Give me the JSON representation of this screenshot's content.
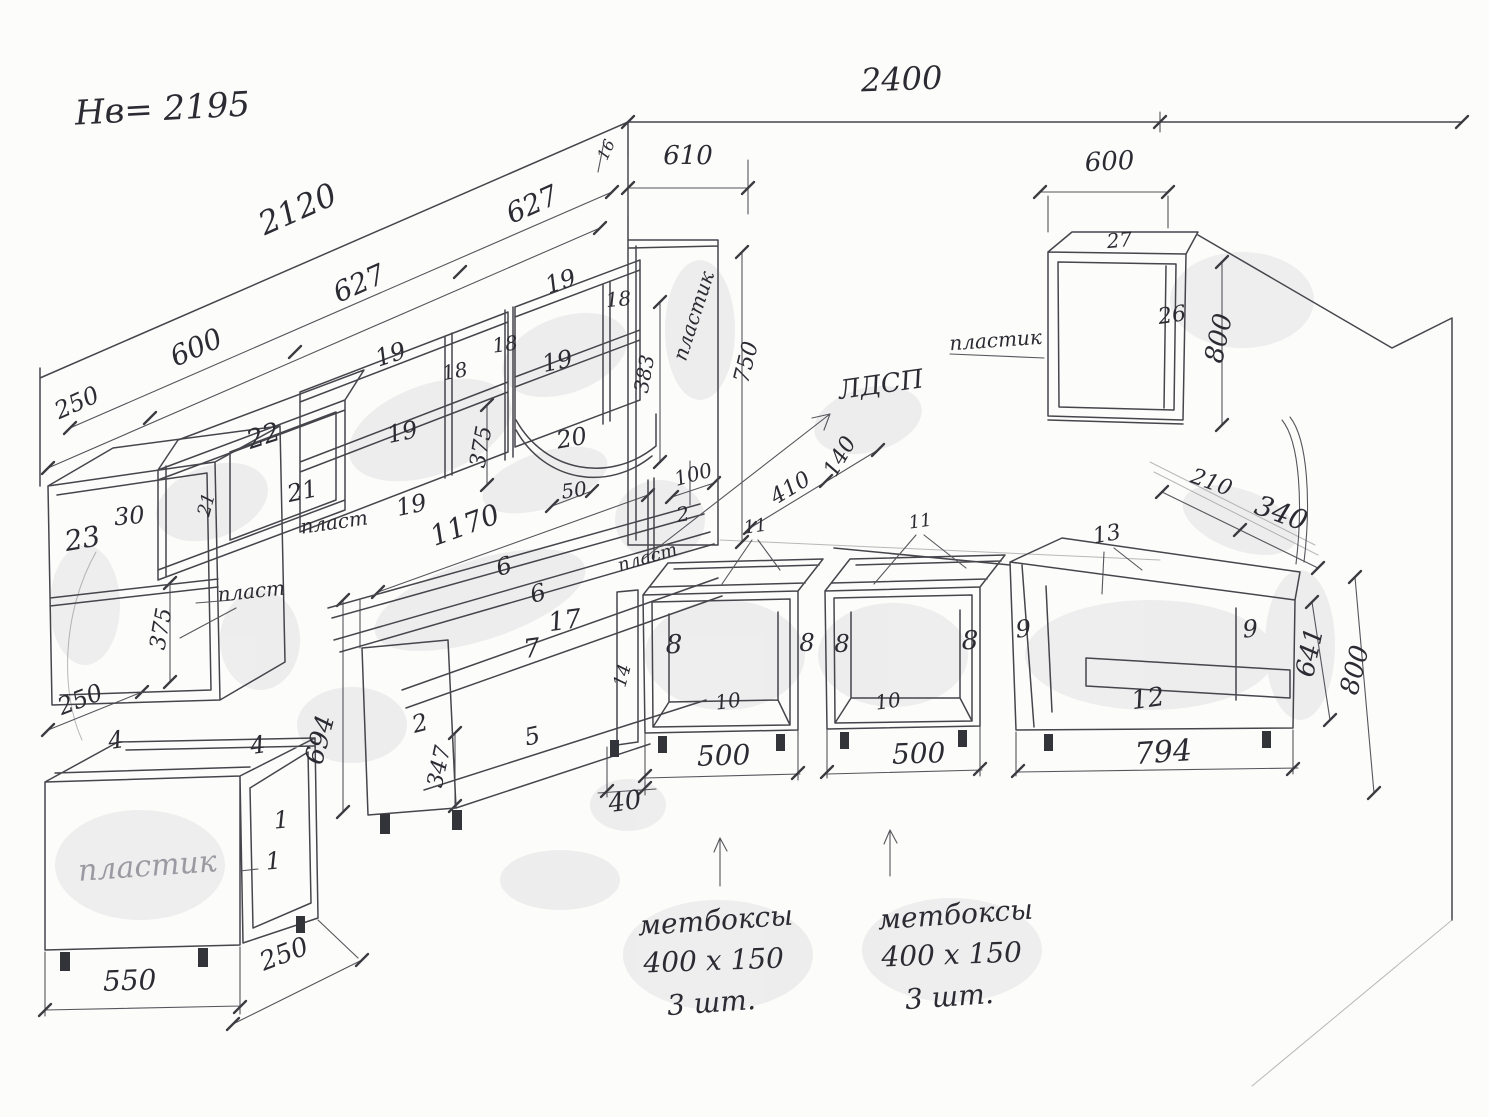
{
  "sheet": {
    "kind": "hand-drawn kitchen cabinet dimension sketch"
  },
  "labels": [
    {
      "n": "header-height-note",
      "t": "Нв= 2195",
      "x": 163,
      "y": 120,
      "r": -3,
      "s": 34
    },
    {
      "n": "dim-top-wall-2400",
      "t": "2400",
      "x": 902,
      "y": 90,
      "r": -2,
      "s": 32
    },
    {
      "n": "dim-left-wall-2120",
      "t": "2120",
      "x": 302,
      "y": 219,
      "r": -24,
      "s": 32
    },
    {
      "n": "dim-left-627-upper",
      "t": "627",
      "x": 536,
      "y": 213,
      "r": -24,
      "s": 28
    },
    {
      "n": "dim-left-627-lower",
      "t": "627",
      "x": 363,
      "y": 292,
      "r": -24,
      "s": 28
    },
    {
      "n": "dim-left-600",
      "t": "600",
      "x": 200,
      "y": 356,
      "r": -24,
      "s": 28
    },
    {
      "n": "dim-left-250",
      "t": "250",
      "x": 80,
      "y": 410,
      "r": -24,
      "s": 24
    },
    {
      "n": "dim-corner-610",
      "t": "610",
      "x": 688,
      "y": 164,
      "r": 0,
      "s": 26
    },
    {
      "n": "dim-corner-16",
      "t": "16",
      "x": 611,
      "y": 152,
      "r": -65,
      "s": 16
    },
    {
      "n": "dim-right-600",
      "t": "600",
      "x": 1110,
      "y": 170,
      "r": -3,
      "s": 26
    },
    {
      "n": "part-27-top",
      "t": "27",
      "x": 1120,
      "y": 247,
      "r": -5,
      "s": 20
    },
    {
      "n": "part-26-side",
      "t": "26",
      "x": 1173,
      "y": 322,
      "r": -8,
      "s": 22
    },
    {
      "n": "dim-right-800-upper",
      "t": "800",
      "x": 1227,
      "y": 340,
      "r": -78,
      "s": 26
    },
    {
      "n": "note-plastik-right",
      "t": "пластик",
      "x": 996,
      "y": 347,
      "r": -4,
      "s": 20
    },
    {
      "n": "note-ldsp",
      "t": "ЛДСП",
      "x": 882,
      "y": 393,
      "r": -8,
      "s": 26
    },
    {
      "n": "part-22-top",
      "t": "22",
      "x": 266,
      "y": 444,
      "r": -18,
      "s": 26
    },
    {
      "n": "part-21-back",
      "t": "21",
      "x": 304,
      "y": 499,
      "r": -12,
      "s": 24
    },
    {
      "n": "part-21-side",
      "t": "21",
      "x": 212,
      "y": 506,
      "r": -75,
      "s": 18
    },
    {
      "n": "part-23",
      "t": "23",
      "x": 84,
      "y": 548,
      "r": -10,
      "s": 28
    },
    {
      "n": "part-30",
      "t": "30",
      "x": 130,
      "y": 524,
      "r": -5,
      "s": 24
    },
    {
      "n": "dim-23-375",
      "t": "375",
      "x": 168,
      "y": 630,
      "r": -80,
      "s": 22
    },
    {
      "n": "note-plast-23",
      "t": "пласт",
      "x": 252,
      "y": 598,
      "r": -6,
      "s": 20
    },
    {
      "n": "note-plast-22",
      "t": "пласт",
      "x": 335,
      "y": 529,
      "r": -8,
      "s": 20
    },
    {
      "n": "part-19-top-left",
      "t": "19",
      "x": 393,
      "y": 362,
      "r": -18,
      "s": 24
    },
    {
      "n": "part-18-divider-left",
      "t": "18",
      "x": 456,
      "y": 378,
      "r": -10,
      "s": 20
    },
    {
      "n": "part-19-mid-left",
      "t": "19",
      "x": 404,
      "y": 440,
      "r": -12,
      "s": 24
    },
    {
      "n": "part-19-bottom-left",
      "t": "19",
      "x": 413,
      "y": 513,
      "r": -12,
      "s": 24
    },
    {
      "n": "part-18-divider-tall",
      "t": "18",
      "x": 506,
      "y": 351,
      "r": -8,
      "s": 20
    },
    {
      "n": "part-19-top-right",
      "t": "19",
      "x": 563,
      "y": 289,
      "r": -18,
      "s": 24
    },
    {
      "n": "part-18-divider-right",
      "t": "18",
      "x": 619,
      "y": 306,
      "r": -5,
      "s": 20
    },
    {
      "n": "part-19-mid-right",
      "t": "19",
      "x": 559,
      "y": 369,
      "r": -12,
      "s": 24
    },
    {
      "n": "dim-shelf-375",
      "t": "375",
      "x": 488,
      "y": 448,
      "r": -80,
      "s": 22
    },
    {
      "n": "part-20-curved-shelf",
      "t": "20",
      "x": 573,
      "y": 446,
      "r": -10,
      "s": 24
    },
    {
      "n": "dim-corner-383",
      "t": "383",
      "x": 651,
      "y": 375,
      "r": -80,
      "s": 20
    },
    {
      "n": "note-plastik-corner",
      "t": "пластик",
      "x": 700,
      "y": 318,
      "r": -72,
      "s": 20
    },
    {
      "n": "dim-corner-750",
      "t": "750",
      "x": 753,
      "y": 364,
      "r": -76,
      "s": 22
    },
    {
      "n": "dim-counter-1170",
      "t": "1170",
      "x": 468,
      "y": 534,
      "r": -20,
      "s": 28
    },
    {
      "n": "dim-corner-50",
      "t": "50",
      "x": 575,
      "y": 497,
      "r": -8,
      "s": 20
    },
    {
      "n": "dim-corner-100",
      "t": "100",
      "x": 695,
      "y": 481,
      "r": -15,
      "s": 20
    },
    {
      "n": "part-2-corner",
      "t": "2",
      "x": 684,
      "y": 521,
      "r": -10,
      "s": 20
    },
    {
      "n": "note-plast-corner",
      "t": "пласт",
      "x": 649,
      "y": 563,
      "r": -16,
      "s": 18
    },
    {
      "n": "dim-corner-410",
      "t": "410",
      "x": 794,
      "y": 494,
      "r": -31,
      "s": 22
    },
    {
      "n": "dim-corner-140",
      "t": "140",
      "x": 846,
      "y": 460,
      "r": -60,
      "s": 22
    },
    {
      "n": "part-11-left",
      "t": "11",
      "x": 756,
      "y": 532,
      "r": -8,
      "s": 18
    },
    {
      "n": "part-11-right",
      "t": "11",
      "x": 921,
      "y": 527,
      "r": -8,
      "s": 18
    },
    {
      "n": "part-8-a-left",
      "t": "8",
      "x": 674,
      "y": 653,
      "r": 0,
      "s": 26
    },
    {
      "n": "part-8-a-right",
      "t": "8",
      "x": 807,
      "y": 651,
      "r": 0,
      "s": 24
    },
    {
      "n": "part-10-a",
      "t": "10",
      "x": 729,
      "y": 708,
      "r": -8,
      "s": 20
    },
    {
      "n": "dim-500-a",
      "t": "500",
      "x": 724,
      "y": 765,
      "r": -2,
      "s": 28
    },
    {
      "n": "part-8-b-left",
      "t": "8",
      "x": 842,
      "y": 652,
      "r": 0,
      "s": 24
    },
    {
      "n": "part-8-b-right",
      "t": "8",
      "x": 970,
      "y": 649,
      "r": 0,
      "s": 26
    },
    {
      "n": "part-10-b",
      "t": "10",
      "x": 889,
      "y": 708,
      "r": -8,
      "s": 20
    },
    {
      "n": "dim-500-b",
      "t": "500",
      "x": 919,
      "y": 763,
      "r": -2,
      "s": 28
    },
    {
      "n": "part-14-divider",
      "t": "14",
      "x": 628,
      "y": 677,
      "r": -75,
      "s": 18
    },
    {
      "n": "dim-40",
      "t": "40",
      "x": 626,
      "y": 810,
      "r": -8,
      "s": 26
    },
    {
      "n": "part-6-backsplash",
      "t": "6",
      "x": 506,
      "y": 574,
      "r": -15,
      "s": 24
    },
    {
      "n": "part-6-countertop",
      "t": "6",
      "x": 540,
      "y": 601,
      "r": -15,
      "s": 24
    },
    {
      "n": "part-17-rail",
      "t": "17",
      "x": 566,
      "y": 629,
      "r": -8,
      "s": 26
    },
    {
      "n": "part-7-rail",
      "t": "7",
      "x": 533,
      "y": 657,
      "r": -8,
      "s": 26
    },
    {
      "n": "part-5-drawer",
      "t": "5",
      "x": 534,
      "y": 744,
      "r": -12,
      "s": 24
    },
    {
      "n": "part-2-drawer",
      "t": "2",
      "x": 422,
      "y": 731,
      "r": -15,
      "s": 24
    },
    {
      "n": "dim-347",
      "t": "347",
      "x": 446,
      "y": 768,
      "r": -78,
      "s": 22
    },
    {
      "n": "dim-694",
      "t": "694",
      "x": 328,
      "y": 742,
      "r": -75,
      "s": 26
    },
    {
      "n": "part-4-front-rail",
      "t": "4",
      "x": 117,
      "y": 748,
      "r": -8,
      "s": 24
    },
    {
      "n": "part-4-back-rail",
      "t": "4",
      "x": 259,
      "y": 753,
      "r": -8,
      "s": 24
    },
    {
      "n": "part-1-side",
      "t": "1",
      "x": 282,
      "y": 828,
      "r": -5,
      "s": 24
    },
    {
      "n": "part-1-back",
      "t": "1",
      "x": 274,
      "y": 869,
      "r": -5,
      "s": 24
    },
    {
      "n": "note-plastik-front",
      "t": "пластик",
      "x": 148,
      "y": 876,
      "r": -4,
      "s": 30,
      "c": "faded"
    },
    {
      "n": "dim-550",
      "t": "550",
      "x": 130,
      "y": 990,
      "r": -2,
      "s": 28
    },
    {
      "n": "dim-250-depth",
      "t": "250",
      "x": 287,
      "y": 962,
      "r": -21,
      "s": 26
    },
    {
      "n": "dim-250-under-23",
      "t": "250",
      "x": 83,
      "y": 707,
      "r": -21,
      "s": 24
    },
    {
      "n": "part-9-left",
      "t": "9",
      "x": 1024,
      "y": 637,
      "r": -5,
      "s": 24
    },
    {
      "n": "part-9-right",
      "t": "9",
      "x": 1251,
      "y": 637,
      "r": -5,
      "s": 24
    },
    {
      "n": "part-12-bottom",
      "t": "12",
      "x": 1149,
      "y": 707,
      "r": -8,
      "s": 26
    },
    {
      "n": "part-13-rail",
      "t": "13",
      "x": 1108,
      "y": 541,
      "r": -10,
      "s": 22
    },
    {
      "n": "dim-794",
      "t": "794",
      "x": 1164,
      "y": 762,
      "r": -4,
      "s": 30
    },
    {
      "n": "dim-641",
      "t": "641",
      "x": 1318,
      "y": 654,
      "r": -78,
      "s": 26
    },
    {
      "n": "dim-800-lower",
      "t": "800",
      "x": 1363,
      "y": 672,
      "r": -76,
      "s": 26
    },
    {
      "n": "dim-210",
      "t": "210",
      "x": 1209,
      "y": 489,
      "r": 20,
      "s": 22
    },
    {
      "n": "dim-340",
      "t": "340",
      "x": 1278,
      "y": 522,
      "r": 20,
      "s": 28
    },
    {
      "n": "note-mebox-left-line1",
      "t": "метбоксы",
      "x": 716,
      "y": 930,
      "r": -4,
      "s": 28
    },
    {
      "n": "note-mebox-left-line2",
      "t": "400 х 150",
      "x": 714,
      "y": 970,
      "r": -2,
      "s": 28
    },
    {
      "n": "note-mebox-left-line3",
      "t": "3 шт.",
      "x": 712,
      "y": 1012,
      "r": -4,
      "s": 28
    },
    {
      "n": "note-mebox-right-line1",
      "t": "метбоксы",
      "x": 956,
      "y": 924,
      "r": -4,
      "s": 28
    },
    {
      "n": "note-mebox-right-line2",
      "t": "400 х 150",
      "x": 952,
      "y": 964,
      "r": -2,
      "s": 28
    },
    {
      "n": "note-mebox-right-line3",
      "t": "3 шт.",
      "x": 950,
      "y": 1006,
      "r": -4,
      "s": 28
    }
  ]
}
